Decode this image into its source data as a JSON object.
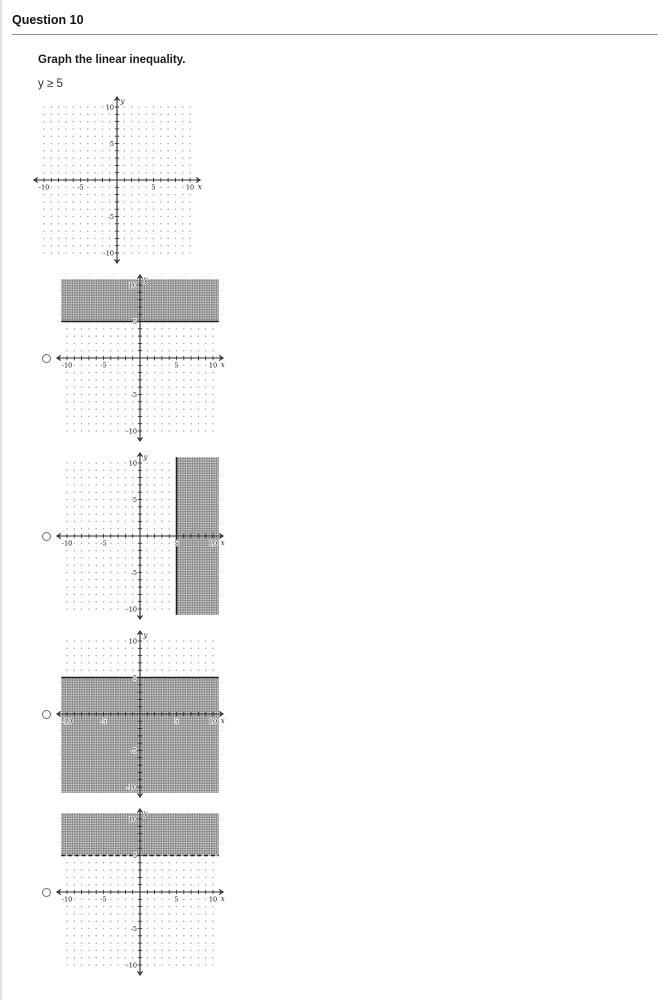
{
  "question": {
    "number_label": "Question 10",
    "prompt": "Graph the linear inequality.",
    "inequality": "y ≥ 5"
  },
  "colors": {
    "axis": "#2b2b2b",
    "grid_dot": "#aaaaaa",
    "mesh": "#8d8d8d",
    "boundary": "#1d1d1d",
    "header_rule": "#929292",
    "page_edge": "#e2e2e2",
    "radio_ring": "#6f6f6f"
  },
  "graph_defaults": {
    "xlabel": "x",
    "ylabel": "y",
    "xlim": [
      -11.4,
      11.4
    ],
    "ylim": [
      -11.4,
      11.4
    ],
    "tick_min": -11,
    "tick_max": 11,
    "tick_step": 1,
    "x_tick_labels": [
      -10,
      -5,
      5,
      10
    ],
    "y_tick_labels": [
      10,
      5,
      -5,
      -10
    ],
    "grid": "dotted integer lattice -10..10",
    "legend": "none"
  },
  "chart_data": [
    {
      "type": "area",
      "role": "question-figure",
      "description": "Blank dotted coordinate plane, x and y from -10 to 10",
      "region": null
    },
    {
      "type": "area",
      "role": "answer-option",
      "option": "A",
      "depicts_inequality": "y ≥ 5",
      "region": {
        "shade": "above boundary",
        "bounds": {
          "x1": -10.8,
          "x2": 10.8,
          "y1": 5,
          "y2": 10.8
        },
        "boundary": {
          "orientation": "horizontal",
          "value": 5,
          "style": "solid"
        }
      }
    },
    {
      "type": "area",
      "role": "answer-option",
      "option": "B",
      "depicts_inequality": "x ≥ 5",
      "region": {
        "shade": "right of boundary",
        "bounds": {
          "x1": 5,
          "x2": 10.8,
          "y1": -10.8,
          "y2": 10.8
        },
        "boundary": {
          "orientation": "vertical",
          "value": 5,
          "style": "solid"
        }
      }
    },
    {
      "type": "area",
      "role": "answer-option",
      "option": "C",
      "depicts_inequality": "y ≤ 5",
      "region": {
        "shade": "below boundary",
        "bounds": {
          "x1": -10.8,
          "x2": 10.8,
          "y1": -10.8,
          "y2": 5
        },
        "boundary": {
          "orientation": "horizontal",
          "value": 5,
          "style": "solid"
        }
      }
    },
    {
      "type": "area",
      "role": "answer-option",
      "option": "D",
      "depicts_inequality": "y > 5",
      "region": {
        "shade": "above boundary",
        "bounds": {
          "x1": -10.8,
          "x2": 10.8,
          "y1": 5,
          "y2": 10.8
        },
        "boundary": {
          "orientation": "horizontal",
          "value": 5,
          "style": "dashed"
        }
      }
    }
  ],
  "options_state": [
    {
      "option": "A",
      "selected": false
    },
    {
      "option": "B",
      "selected": false
    },
    {
      "option": "C",
      "selected": false
    },
    {
      "option": "D",
      "selected": false
    }
  ]
}
